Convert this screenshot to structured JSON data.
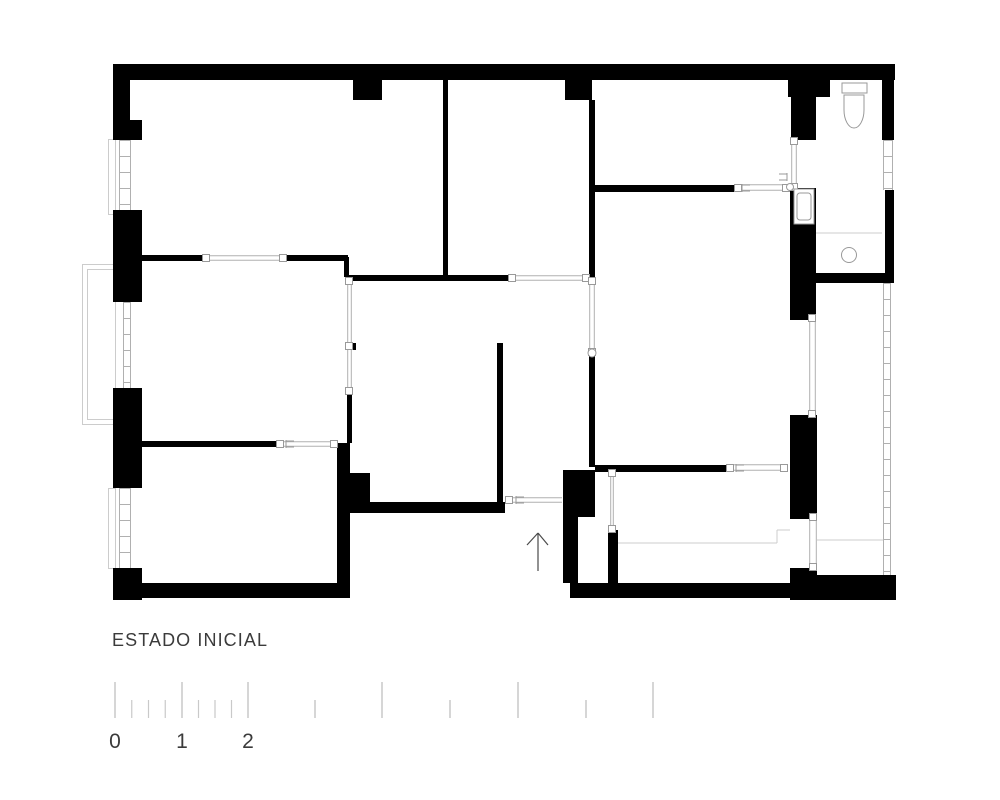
{
  "meta": {
    "bg": "#ffffff",
    "wall": "#000000",
    "line": "#b0b0b0",
    "light": "#cccccc",
    "text": "#3b3b3b",
    "tick": "#c9c9c9",
    "mark": "#999999",
    "arrow": "#4a4a4a"
  },
  "title": {
    "label": "ESTADO INICIAL"
  },
  "plan": {
    "walls": [
      [
        113,
        64,
        782,
        16
      ],
      [
        113,
        64,
        17,
        76
      ],
      [
        113,
        120,
        29,
        20
      ],
      [
        113,
        210,
        29,
        92
      ],
      [
        113,
        388,
        29,
        100
      ],
      [
        113,
        568,
        29,
        32
      ],
      [
        142,
        583,
        208,
        15
      ],
      [
        337,
        443,
        13,
        140
      ],
      [
        350,
        473,
        20,
        29
      ],
      [
        350,
        502,
        155,
        11
      ],
      [
        497,
        343,
        6,
        170
      ],
      [
        345,
        343,
        11,
        7
      ],
      [
        347,
        392,
        5,
        51
      ],
      [
        344,
        257,
        5,
        20
      ],
      [
        142,
        255,
        61,
        6
      ],
      [
        286,
        255,
        62,
        6
      ],
      [
        142,
        441,
        135,
        6
      ],
      [
        331,
        441,
        6,
        6
      ],
      [
        345,
        275,
        163,
        6
      ],
      [
        443,
        79,
        5,
        197
      ],
      [
        353,
        79,
        29,
        21
      ],
      [
        565,
        79,
        27,
        21
      ],
      [
        589,
        100,
        6,
        178
      ],
      [
        589,
        350,
        6,
        117
      ],
      [
        589,
        185,
        146,
        7
      ],
      [
        595,
        465,
        132,
        7
      ],
      [
        563,
        470,
        32,
        47
      ],
      [
        563,
        517,
        15,
        66
      ],
      [
        608,
        530,
        10,
        53
      ],
      [
        570,
        583,
        326,
        15
      ],
      [
        817,
        575,
        79,
        25
      ],
      [
        790,
        568,
        27,
        32
      ],
      [
        790,
        415,
        27,
        104
      ],
      [
        790,
        188,
        26,
        132
      ],
      [
        788,
        79,
        42,
        18
      ],
      [
        791,
        97,
        25,
        43
      ],
      [
        882,
        79,
        12,
        61
      ],
      [
        885,
        190,
        9,
        85
      ],
      [
        813,
        273,
        81,
        10
      ]
    ],
    "openings": [
      [
        210,
        255,
        70,
        6,
        "h"
      ],
      [
        283,
        441,
        48,
        6,
        "h"
      ],
      [
        515,
        275,
        69,
        6,
        "h"
      ],
      [
        513,
        497,
        49,
        6,
        "h"
      ],
      [
        733,
        464,
        50,
        7,
        "h"
      ],
      [
        740,
        184,
        49,
        7,
        "h"
      ],
      [
        347,
        283,
        5,
        60,
        "v"
      ],
      [
        347,
        350,
        5,
        42,
        "v"
      ],
      [
        589,
        283,
        6,
        67,
        "v"
      ],
      [
        791,
        140,
        6,
        48,
        "v"
      ],
      [
        809,
        320,
        7,
        95,
        "v"
      ],
      [
        809,
        519,
        8,
        49,
        "v"
      ],
      [
        610,
        472,
        4,
        58,
        "v"
      ]
    ],
    "windows": [
      [
        119,
        140,
        12,
        70
      ],
      [
        123,
        302,
        8,
        86
      ],
      [
        119,
        488,
        12,
        80
      ],
      [
        883,
        140,
        10,
        50
      ],
      [
        883,
        283,
        8,
        292
      ]
    ],
    "light_rects": [
      [
        82,
        264,
        33,
        160
      ],
      [
        87,
        269,
        28,
        150
      ],
      [
        108,
        139,
        7,
        75
      ],
      [
        108,
        488,
        7,
        80
      ]
    ],
    "light_lines": [
      [
        618,
        543,
        777,
        543
      ],
      [
        777,
        530,
        777,
        543
      ],
      [
        777,
        530,
        790,
        530
      ],
      [
        817,
        540,
        883,
        540
      ],
      [
        816,
        233,
        882,
        233
      ]
    ],
    "jambs": [
      [
        206,
        258
      ],
      [
        283,
        258
      ],
      [
        280,
        444
      ],
      [
        334,
        444
      ],
      [
        512,
        278
      ],
      [
        586,
        278
      ],
      [
        509,
        500
      ],
      [
        738,
        188
      ],
      [
        786,
        188
      ],
      [
        730,
        468
      ],
      [
        784,
        468
      ],
      [
        794,
        141
      ],
      [
        794,
        187
      ],
      [
        812,
        318
      ],
      [
        812,
        414
      ],
      [
        813,
        517
      ],
      [
        813,
        567
      ],
      [
        349,
        281
      ],
      [
        349,
        346
      ],
      [
        349,
        391
      ],
      [
        592,
        281
      ],
      [
        592,
        352
      ],
      [
        612,
        473
      ],
      [
        612,
        529
      ]
    ],
    "circles": [
      [
        592,
        353,
        4
      ],
      [
        790,
        187,
        3.5
      ],
      [
        849,
        255,
        7.5
      ],
      [
        797,
        212,
        2
      ]
    ],
    "forks": [
      [
        516,
        500,
        8
      ],
      [
        286,
        444,
        8
      ],
      [
        742,
        188,
        8
      ],
      [
        736,
        468,
        8
      ],
      [
        787,
        177,
        -8
      ]
    ],
    "toilet": {
      "tank": [
        842,
        83,
        25,
        10
      ],
      "bowl": [
        844,
        95,
        20,
        33
      ]
    },
    "sink": {
      "outer": [
        794,
        189,
        20,
        35
      ],
      "inner": [
        797,
        193,
        14,
        27
      ]
    },
    "north_arrow": {
      "stem": [
        538,
        533,
        538,
        571
      ],
      "left_wing": [
        527,
        545,
        538,
        533
      ],
      "right_wing": [
        548,
        545,
        538,
        533
      ]
    }
  },
  "scale_bar": {
    "tall_ticks": [
      115,
      182,
      248,
      382,
      518,
      653
    ],
    "medium_ticks": [
      315,
      450,
      586
    ],
    "quarter_ticks": [
      131.75,
      148.5,
      165.25,
      198.5,
      215,
      231.5
    ],
    "tick_top_tall": 682,
    "tick_top_short": 700,
    "tick_bottom": 718,
    "labels": [
      {
        "text": "0",
        "x": 115
      },
      {
        "text": "1",
        "x": 182
      },
      {
        "text": "2",
        "x": 248
      }
    ],
    "label_y": 748
  }
}
